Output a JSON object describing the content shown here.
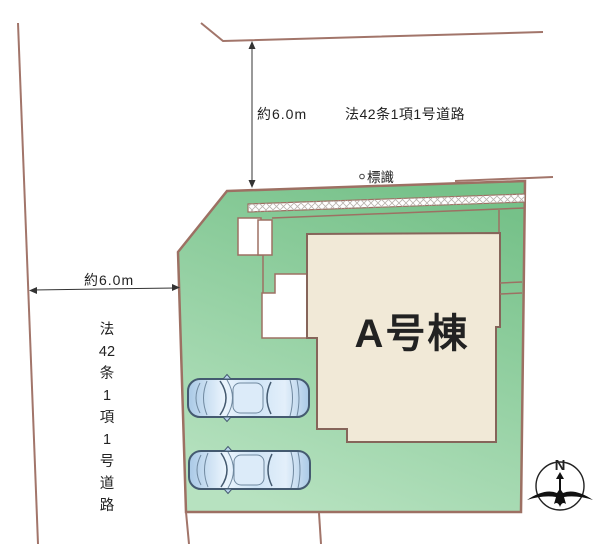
{
  "plan": {
    "building": {
      "label": "A号棟"
    },
    "sign": {
      "label": "標識"
    },
    "dimensions": {
      "top": {
        "label": "約6.0m"
      },
      "left": {
        "label": "約6.0m"
      }
    },
    "roads": {
      "top": {
        "label": "法42条1項1号道路"
      },
      "left": {
        "label": "法42条1項1号道路",
        "label_chars": [
          "法",
          "42",
          "条",
          "1",
          "項",
          "1",
          "号",
          "道",
          "路"
        ]
      }
    },
    "compass": {
      "label": "N"
    },
    "cars": {
      "count": 2
    }
  },
  "colors": {
    "background": "#ffffff",
    "boundary_line": "#a2756a",
    "plot_border": "#9d7063",
    "plot_green_top": "#76c189",
    "plot_green_bottom": "#b7e2c0",
    "building_fill": "#f1e9d7",
    "building_border": "#86655a",
    "approach_fill": "#ffffff",
    "car_blue": "#aecfeb",
    "text": "#222222",
    "compass_ink": "#111111"
  }
}
